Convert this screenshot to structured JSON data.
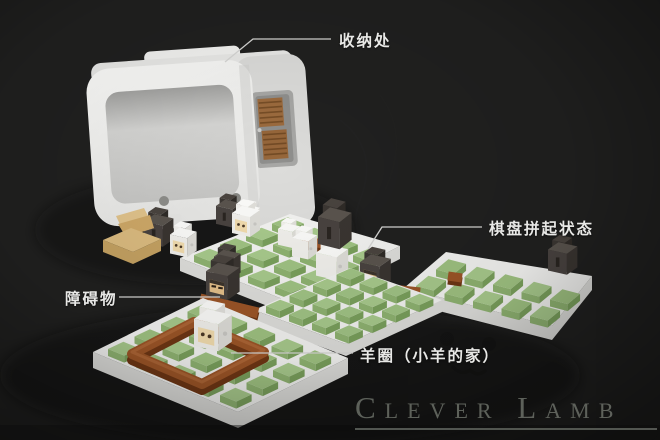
{
  "annotations": {
    "storage": "收纳处",
    "assembled_board": "棋盘拼起状态",
    "obstacle": "障碍物",
    "sheep_pen": "羊圈（小羊的家）"
  },
  "watermark": "Clever Lamb",
  "palette": {
    "background": "#212120",
    "board_white": "#f3f3f1",
    "grass_top": "#a8ca8c",
    "grass_front": "#8fb371",
    "grass_side": "#7aa05c",
    "fence_brown": "#9c5527",
    "wolf_dark": "#494340",
    "wolf_face_tan": "#e5c08a",
    "sheep_white": "#f1f0ec",
    "sheep_face_cream": "#f2dcae",
    "cards_brown": "#9c6b3e",
    "hat_tan": "#d9b87c",
    "label_text": "#e8e8e6",
    "watermark_gray": "#62665f"
  }
}
